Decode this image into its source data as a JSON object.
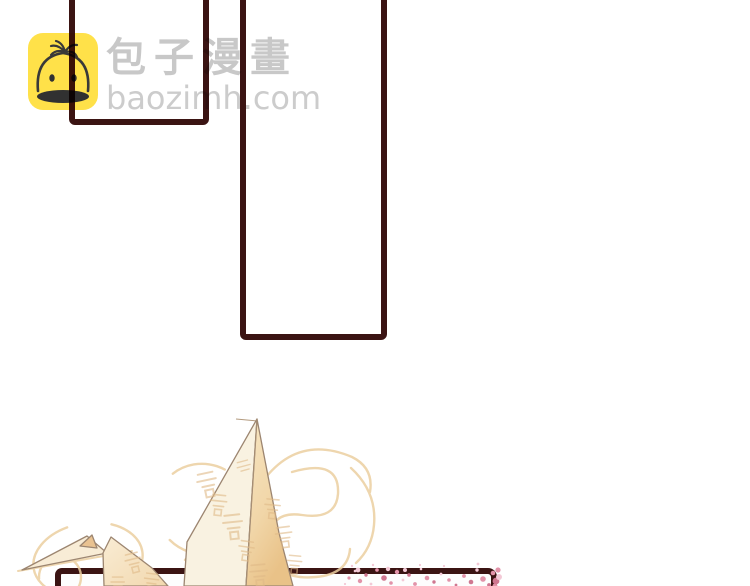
{
  "watermark": {
    "site_name": "包子漫畫",
    "site_url": "baozimh.com",
    "logo_icon": "baozi-bun-icon",
    "logo_background_color": "#ffdf3c",
    "text_color": "#c6c6c6"
  },
  "comic": {
    "panel_border_color": "#3b1413",
    "panel_count": 3,
    "panels": [
      {
        "id": "top-left",
        "content": "empty (cropped)"
      },
      {
        "id": "top-center",
        "content": "empty (cropped)"
      },
      {
        "id": "bottom",
        "content": "origami paper crane with gold swirls and pink blossom speckles (cropped)"
      }
    ],
    "illustration": {
      "subject": "origami-paper-crane",
      "paper_color": "#f7e7c9",
      "swirl_color": "#eccfa0",
      "blossom_color": "#e293a9"
    }
  }
}
